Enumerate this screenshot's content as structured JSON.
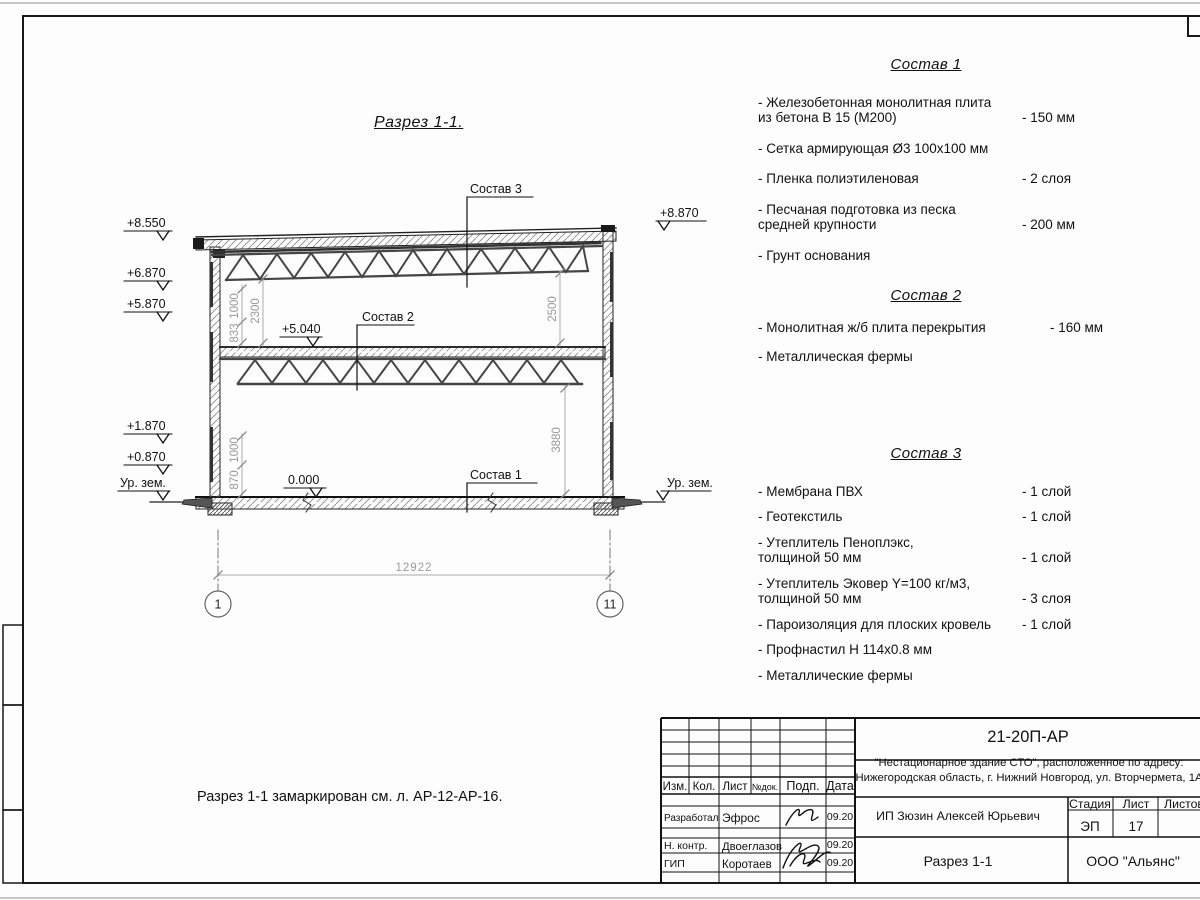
{
  "sheet": {
    "view_title": "Разрез 1-1.",
    "note": "Разрез 1-1 замаркирован см. л. АР-12-АР-16."
  },
  "section": {
    "labels": {
      "layer1": "Состав 1",
      "layer2": "Состав 2",
      "layer3": "Состав 3"
    },
    "elevations": {
      "left": [
        "+8.550",
        "+6.870",
        "+5.870",
        "+1.870",
        "+0.870",
        "Ур. зем."
      ],
      "right_top": "+8.870",
      "right_ground": "Ур. зем.",
      "mid": "+5.040",
      "zero": "0.000"
    },
    "dims": {
      "span": "12922",
      "upper_left_a": "1000",
      "upper_left_b": "833",
      "upper_left_inner": "2300",
      "lower_left_a": "1000",
      "lower_left_b": "870",
      "right_upper": "2500",
      "right_lower": "3880"
    },
    "axes": {
      "left": "1",
      "right": "11"
    }
  },
  "specs": [
    {
      "title": "Состав 1",
      "items": [
        {
          "name": "- Железобетонная  монолитная плита\nиз бетона В 15 (М200)",
          "value": "- 150 мм"
        },
        {
          "name": "- Сетка армирующая Ø3 100х100 мм",
          "value": ""
        },
        {
          "name": "- Пленка полиэтиленовая",
          "value": "- 2 слоя"
        },
        {
          "name": "- Песчаная подготовка из песка\nсредней крупности",
          "value": "- 200 мм"
        },
        {
          "name": "- Грунт основания",
          "value": ""
        }
      ]
    },
    {
      "title": "Состав 2",
      "items": [
        {
          "name": "- Монолитная ж/б плита перекрытия",
          "value": "- 160 мм"
        },
        {
          "name": "- Металлическая фермы",
          "value": ""
        }
      ]
    },
    {
      "title": "Состав 3",
      "items": [
        {
          "name": "- Мембрана ПВХ",
          "value": "- 1 слой"
        },
        {
          "name": "- Геотекстиль",
          "value": "- 1 слой"
        },
        {
          "name": "- Утеплитель Пеноплэкс,\nтолщиной 50 мм",
          "value": "- 1 слой"
        },
        {
          "name": "- Утеплитель Эковер Y=100 кг/м3,\nтолщиной 50 мм",
          "value": "- 3 слоя"
        },
        {
          "name": "- Пароизоляция для плоских кровель",
          "value": "- 1 слой"
        },
        {
          "name": "- Профнастил Н 114х0.8 мм",
          "value": ""
        },
        {
          "name": "- Металлические фермы",
          "value": ""
        }
      ]
    }
  ],
  "titleblock": {
    "doc_number": "21-20П-АР",
    "project_line1": "\"Нестационарное здание СТО\", расположенное по адресу:",
    "project_line2": "Нижегородская область, г. Нижний Новгород, ул. Вторчермета, 1А",
    "client": "ИП Зюзин Алексей Юрьевич",
    "sheet_title": "Разрез 1-1",
    "company": "ООО \"Альянс\"",
    "cols": {
      "izm": "Изм.",
      "kol": "Кол.",
      "list": "Лист",
      "ndok": "№док.",
      "podp": "Подп.",
      "data": "Дата"
    },
    "stage_label": "Стадия",
    "list_label": "Лист",
    "listov_label": "Листов",
    "stage": "ЭП",
    "sheet_no": "17",
    "sign_rows": [
      {
        "role": "Разработал",
        "name": "Эфрос",
        "date": "09.20"
      },
      {
        "role": "Н. контр.",
        "name": "Двоеглазов",
        "date": "09.20"
      },
      {
        "role": "ГИП",
        "name": "Коротаев",
        "date": "09.20"
      }
    ]
  }
}
